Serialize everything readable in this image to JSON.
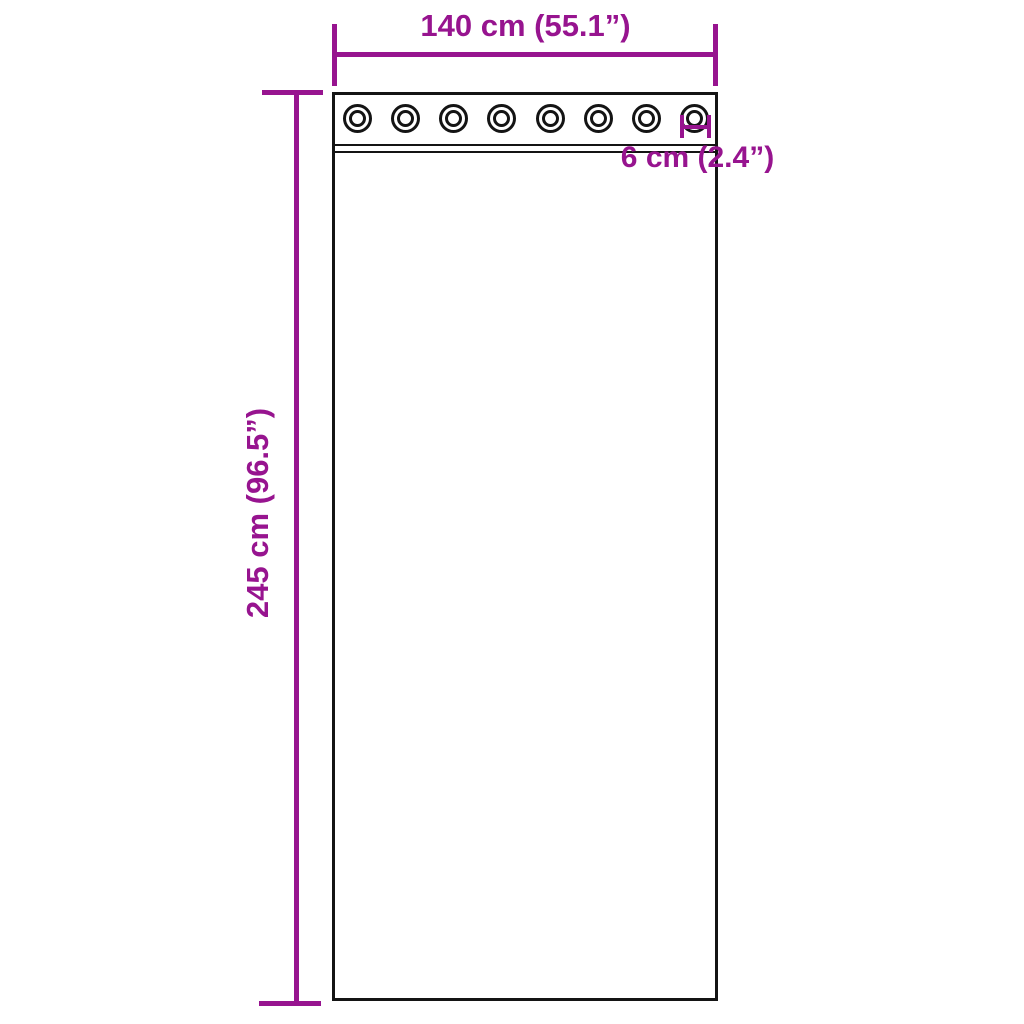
{
  "diagram": {
    "type": "product-dimension-diagram",
    "subject": "curtain-panel-with-grommets",
    "colors": {
      "dimension": "#97148F",
      "outline": "#141414",
      "background": "#ffffff"
    },
    "curtain": {
      "grommet_count": 8
    },
    "labels": {
      "width": "140 cm (55.1”)",
      "height": "245 cm (96.5”)",
      "grommet_spacing": "6 cm (2.4”)"
    }
  }
}
